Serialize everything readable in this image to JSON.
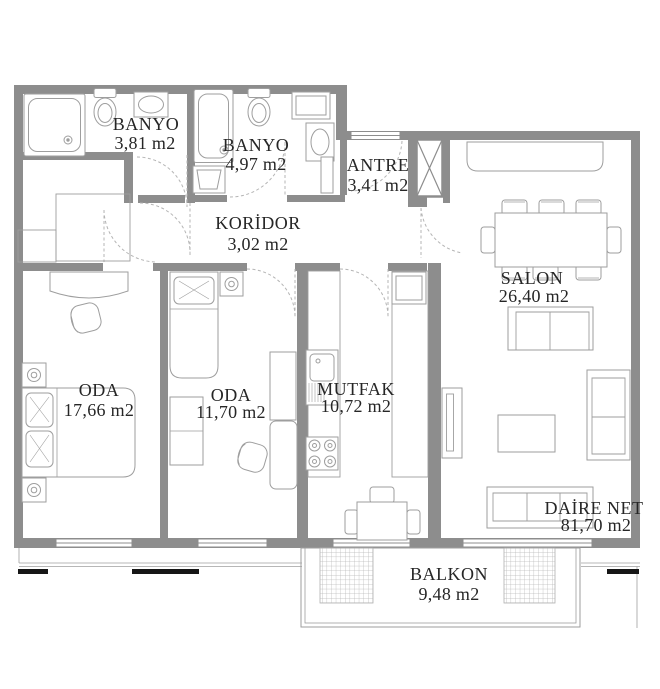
{
  "plan": {
    "type": "apartment-floor-plan",
    "unit": "m2",
    "rooms": [
      {
        "id": "banyo-1",
        "name": "BANYO",
        "area": "3,81 m2"
      },
      {
        "id": "banyo-2",
        "name": "BANYO",
        "area": "4,97 m2"
      },
      {
        "id": "antre",
        "name": "ANTRE",
        "area": "3,41 m2"
      },
      {
        "id": "koridor",
        "name": "KORİDOR",
        "area": "3,02 m2"
      },
      {
        "id": "salon",
        "name": "SALON",
        "area": "26,40 m2"
      },
      {
        "id": "oda-1",
        "name": "ODA",
        "area": "17,66 m2"
      },
      {
        "id": "oda-2",
        "name": "ODA",
        "area": "11,70 m2"
      },
      {
        "id": "mutfak",
        "name": "MUTFAK",
        "area": "10,72 m2"
      },
      {
        "id": "balkon",
        "name": "BALKON",
        "area": "9,48 m2"
      }
    ],
    "summary": {
      "label": "DAİRE NET",
      "area": "81,70 m2"
    },
    "colors": {
      "wall": "#8d8d8d",
      "furniture": "#9e9e9e",
      "hairline": "#ababab",
      "door_swing": "#b4b4b4",
      "hatch": "#b6b6b6",
      "text": "#262626",
      "railing": "#161616",
      "background": "#ffffff"
    }
  }
}
